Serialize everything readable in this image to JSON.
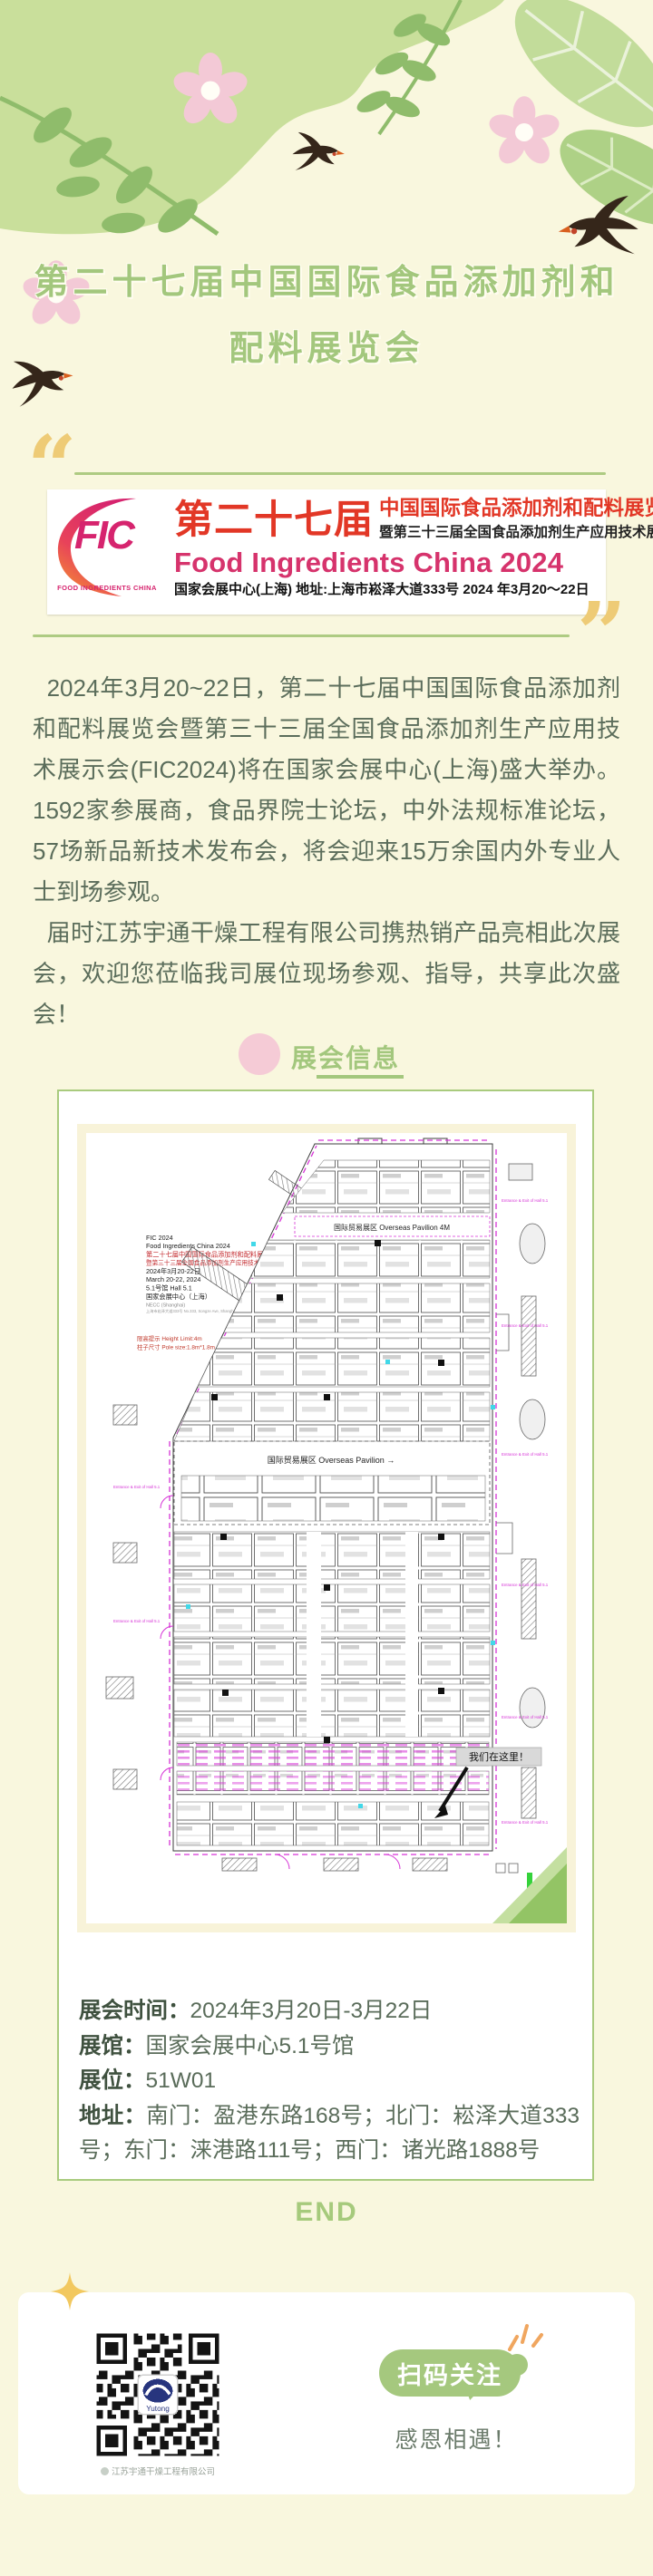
{
  "theme": {
    "page_bg": "#f9f7de",
    "green": "#a3c77d",
    "blob_green": "#c9df9b",
    "leaf_green": "#8fbc6b",
    "pink": "#f4c9d5",
    "gold": "#eecb76",
    "magenta": "#d6246e",
    "red": "#e23726",
    "text_green": "#5b6d5b"
  },
  "decor": {
    "quote_open": "“",
    "quote_close": "”"
  },
  "header": {
    "title_line1": "第二十七届中国国际食品添加剂和",
    "title_line2": "配料展览会"
  },
  "banner": {
    "logo_text": "FIC",
    "logo_sub": "FOOD INGREDIENTS CHINA",
    "session": "第二十七届",
    "cn_title": "中国国际食品添加剂和配料展览会",
    "cn_subtitle": "暨第三十三届全国食品添加剂生产应用技术展示会",
    "en_title": "Food Ingredients China 2024",
    "venue_line": "国家会展中心(上海) 地址:上海市崧泽大道333号 2024 年3月20～22日"
  },
  "intro": {
    "paragraph1": "2024年3月20~22日，第二十七届中国国际食品添加剂和配料展览会暨第三十三届全国食品添加剂生产应用技术展示会(FIC2024)将在国家会展中心(上海)盛大举办。1592家参展商，食品界院士论坛，中外法规标准论坛，57场新品新技术发布会，将会迎来15万余国内外专业人士到场参观。",
    "paragraph2": "届时江苏宇通干燥工程有限公司携热销产品亮相此次展会，欢迎您莅临我司展位现场参观、指导，共享此次盛会！"
  },
  "section": {
    "title": "展会信息"
  },
  "plan": {
    "header_lines": [
      "FIC 2024",
      "Food Ingredients China 2024",
      "第二十七届中国国际食品添加剂和配料展览会",
      "暨第三十三届全国食品添加剂生产应用技术展示会",
      "2024年3月20-22日",
      "March 20-22, 2024",
      "5.1号馆  Hall 5.1",
      "国家会展中心（上海）",
      "NECC (Shanghai)",
      "上海市崧泽大道333号 No.333, Songze Ave, Shanghai, China"
    ],
    "red_note1": "限高提示 Height Limit:4m",
    "red_note2": "柱子尺寸 Pole size:1.8m*1.8m",
    "pavilion_label_top": "国际贸易展区  Overseas Pavilion  4M",
    "pavilion_label_mid": "国际贸易展区  Overseas Pavilion  →",
    "here_label": "我们在这里！",
    "entrance_label": "Entrance & Exit of Hall 5.1"
  },
  "details": {
    "rows": [
      {
        "label": "展会时间：",
        "value": "2024年3月20日-3月22日"
      },
      {
        "label": "展馆：",
        "value": "国家会展中心5.1号馆"
      },
      {
        "label": "展位：",
        "value": "51W01"
      },
      {
        "label": "地址：",
        "value": "南门：盈港东路168号；北门：崧泽大道333号；东门：涞港路111号；西门：诸光路1888号"
      }
    ]
  },
  "footer": {
    "end_label": "END",
    "follow_label": "扫码关注",
    "thanks": "感恩相遇！",
    "qr_caption": "江苏宇通干燥工程有限公司",
    "qr_logo_text": "Yutong"
  }
}
